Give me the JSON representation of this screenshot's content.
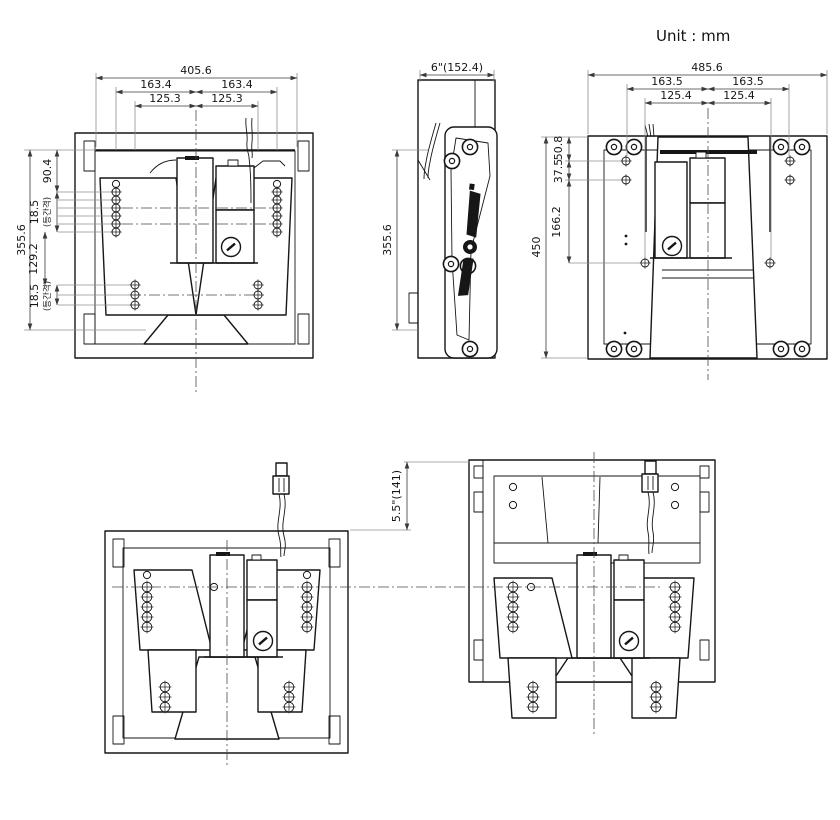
{
  "unit_label": "Unit : mm",
  "colors": {
    "line": "#161616",
    "leader": "#8f8f8f",
    "background": "#ffffff"
  },
  "front_view": {
    "dim_overall_width": "405.6",
    "dim_hole_span_left": "163.4",
    "dim_hole_span_right": "163.4",
    "dim_inner_span_left": "125.3",
    "dim_inner_span_right": "125.3",
    "dim_overall_height": "355.6",
    "dim_top_offset": "90.4",
    "dim_top_pitch": "18.5",
    "dim_top_pitch_note": "(등간격)",
    "dim_mid_span": "129.2",
    "dim_bottom_pitch": "18.5",
    "dim_bottom_pitch_note": "(등간격)"
  },
  "side_view": {
    "dim_depth": "6\"(152.4)",
    "dim_height": "355.6",
    "logo_icon": "brand-logo"
  },
  "rear_view": {
    "dim_overall_width": "485.6",
    "dim_hole_span_left": "163.5",
    "dim_hole_span_right": "163.5",
    "dim_inner_span_left": "125.4",
    "dim_inner_span_right": "125.4",
    "dim_overall_height": "450",
    "dim_top_to_hole": "50.8",
    "dim_hole_pitch": "37.5",
    "dim_mid_span": "166.2"
  },
  "travel_view": {
    "dim_drop": "5.5\"(141)"
  }
}
